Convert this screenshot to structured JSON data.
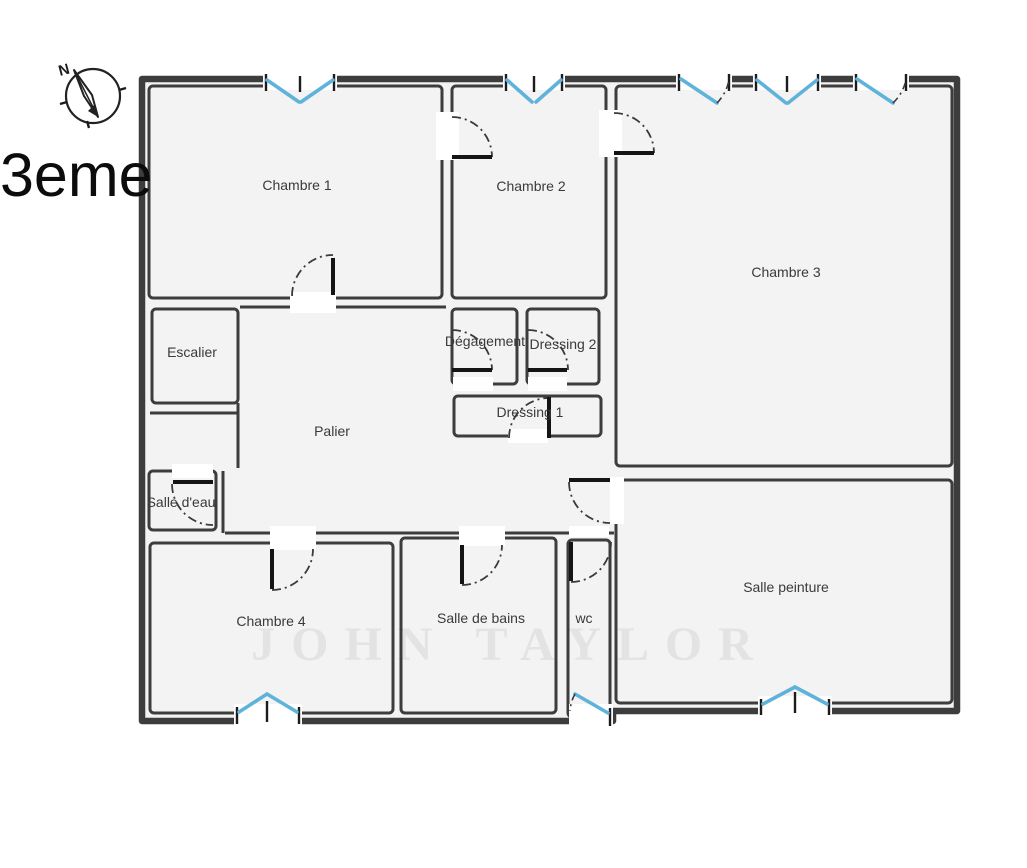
{
  "floor": {
    "label": "3eme"
  },
  "compass": {
    "icon": "compass-north-icon",
    "north_label": "N"
  },
  "rooms": [
    {
      "id": "chambre-1",
      "label": "Chambre 1"
    },
    {
      "id": "chambre-2",
      "label": "Chambre 2"
    },
    {
      "id": "chambre-3",
      "label": "Chambre 3"
    },
    {
      "id": "escalier",
      "label": "Escalier"
    },
    {
      "id": "degagement",
      "label": "Dégagement"
    },
    {
      "id": "dressing-2",
      "label": "Dressing 2"
    },
    {
      "id": "dressing-1",
      "label": "Dressing 1"
    },
    {
      "id": "palier",
      "label": "Palier"
    },
    {
      "id": "salle-d-eau",
      "label": "Salle d'eau"
    },
    {
      "id": "chambre-4",
      "label": "Chambre 4"
    },
    {
      "id": "salle-de-bains",
      "label": "Salle de bains"
    },
    {
      "id": "wc",
      "label": "wc"
    },
    {
      "id": "salle-peinture",
      "label": "Salle peinture"
    }
  ],
  "watermark": {
    "text": "JOHN TAYLOR"
  },
  "colors": {
    "wall": "#3d3d3d",
    "window_blue": "#5fb3da",
    "room_fill": "#f3f3f3",
    "label": "#3a3a3a"
  }
}
